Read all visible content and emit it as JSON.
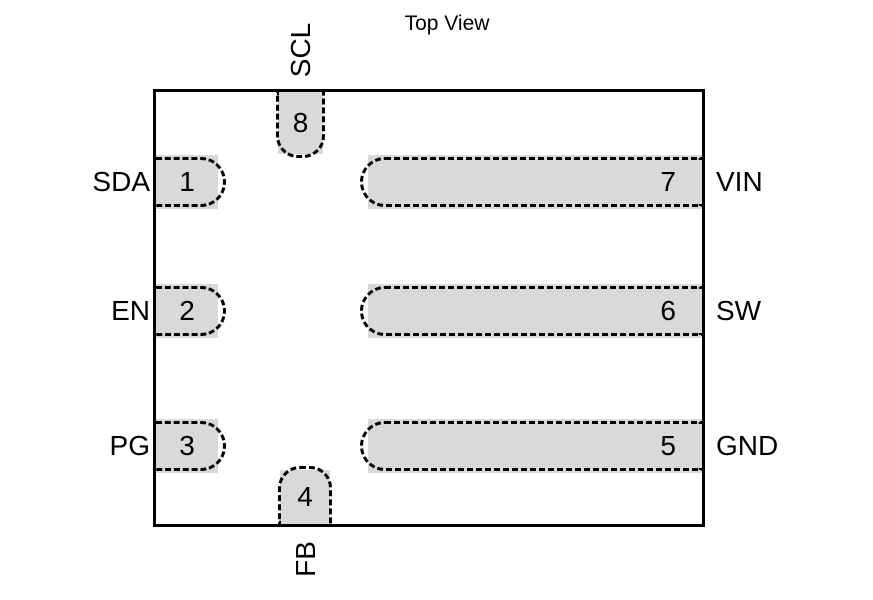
{
  "title": "Top View",
  "colors": {
    "pad_fill": "#d9d9d9",
    "line": "#000000",
    "text": "#000000",
    "background": "#ffffff"
  },
  "pins": [
    {
      "number": "1",
      "label": "SDA",
      "side": "left"
    },
    {
      "number": "2",
      "label": "EN",
      "side": "left"
    },
    {
      "number": "3",
      "label": "PG",
      "side": "left"
    },
    {
      "number": "4",
      "label": "FB",
      "side": "bottom"
    },
    {
      "number": "5",
      "label": "GND",
      "side": "right"
    },
    {
      "number": "6",
      "label": "SW",
      "side": "right"
    },
    {
      "number": "7",
      "label": "VIN",
      "side": "right"
    },
    {
      "number": "8",
      "label": "SCL",
      "side": "top"
    }
  ]
}
